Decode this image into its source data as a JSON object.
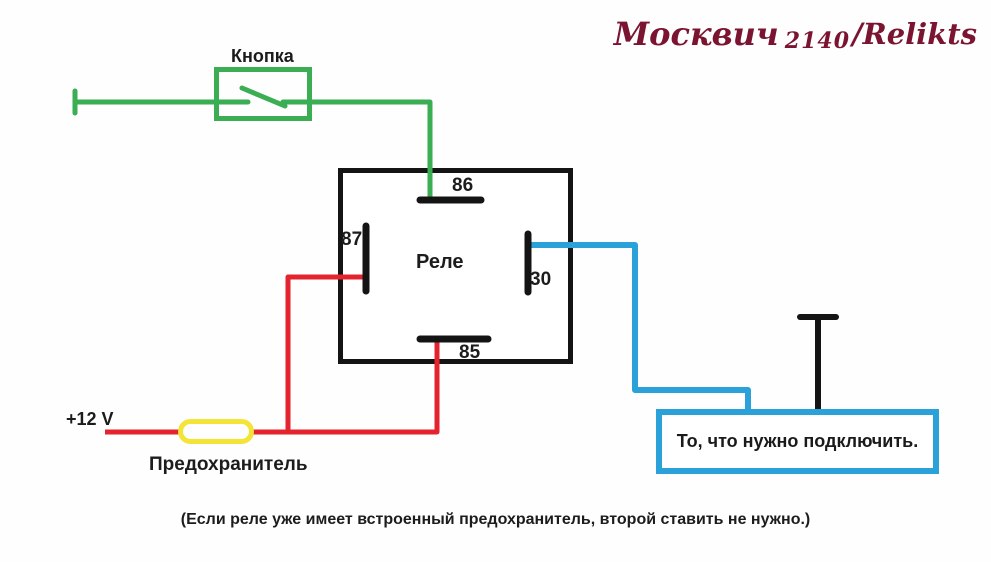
{
  "watermark": {
    "brand": "Москвич",
    "model": "2140",
    "suffix": "/Relikts"
  },
  "labels": {
    "button": "Кнопка",
    "relay": "Реле",
    "terminal_86": "86",
    "terminal_87": "87",
    "terminal_30": "30",
    "terminal_85": "85",
    "supply": "+12 V",
    "fuse": "Предохранитель",
    "load": "То, что нужно подключить.",
    "note": "(Если реле уже имеет встроенный предохранитель, второй ставить не нужно.)"
  },
  "colors": {
    "wire_green": "#3bae53",
    "wire_red": "#e3242e",
    "wire_blue": "#2ba1d9",
    "fuse_yellow": "#f3e435",
    "component_black": "#141414",
    "watermark_maroon": "#7a1430",
    "ink": "#1c1c1c"
  }
}
